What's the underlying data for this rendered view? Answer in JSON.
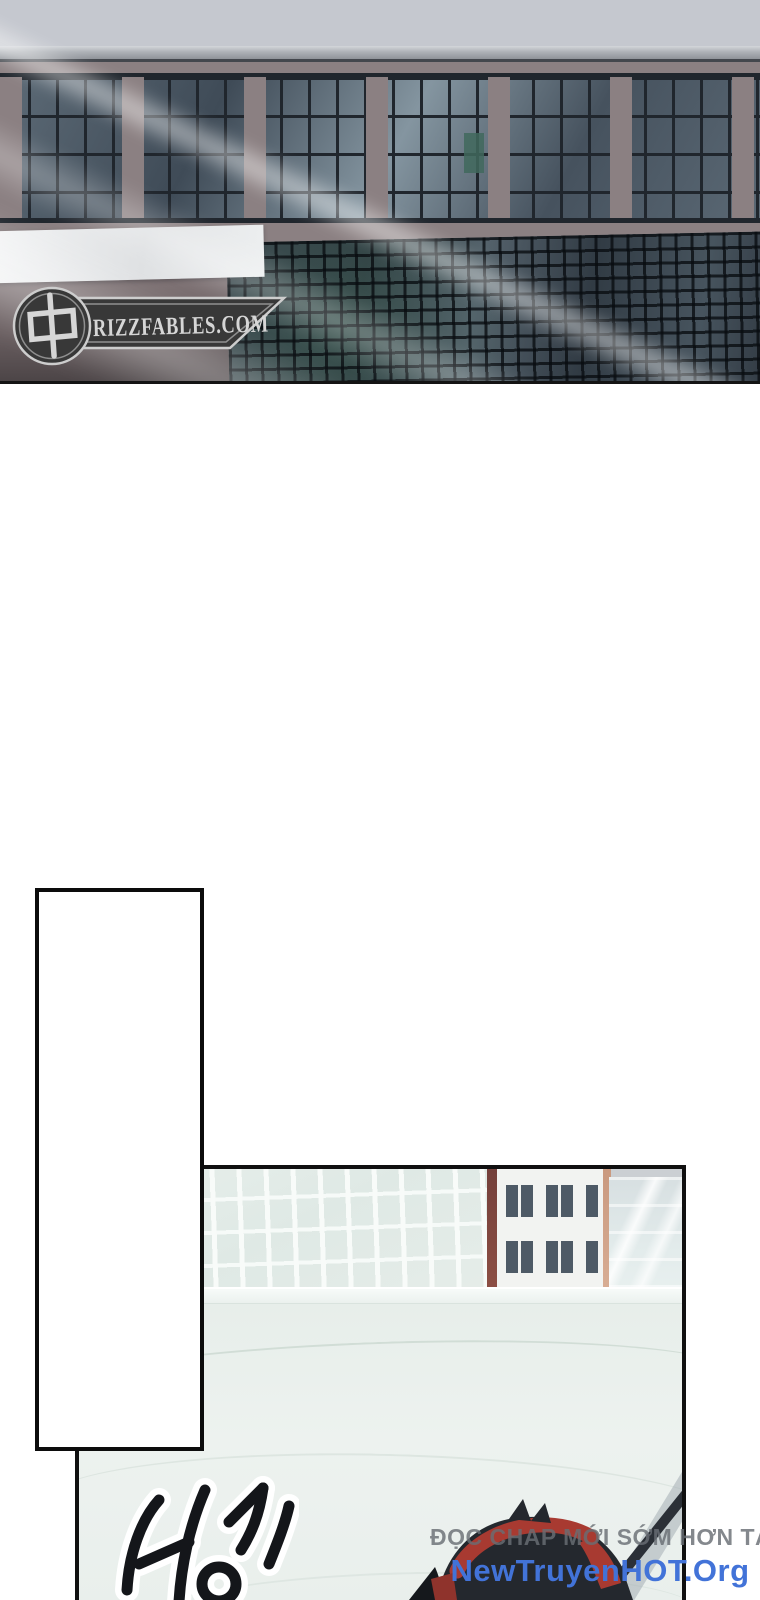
{
  "page": {
    "kind": "webtoon comic page",
    "background_color": "#ffffff"
  },
  "watermark": {
    "site_text": "RIZZFABLES.COM",
    "cjk_glyph": "中",
    "badge_fill": "#383838",
    "badge_outline": "#cdcdcd",
    "text_color": "#d6d6d6"
  },
  "panel1": {
    "description": "building facade with grid windows, white blank signboard and diagonal light streaks",
    "sky_color": "#c5c8cf",
    "wall_color": "#8b8082",
    "window_frame_color": "#20262d",
    "green_pane_color": "#41695d"
  },
  "panel2": {
    "description": "rooftop scene with pale city buildings, parapet, sound effect and partially visible figure with staff",
    "roof_color": "#eaf1ee",
    "building_red_edge": "#74403b",
    "figure_hair_color": "#24282e",
    "figure_red_color": "#a83a31"
  },
  "panel3": {
    "description": "empty white panel"
  },
  "sfx": {
    "text": "빙글",
    "style": "black brush strokes with white outline, rotated"
  },
  "promo": {
    "line1": "ĐỌC CHAP MỚI SỚM HƠN TẠI",
    "line2": "NewTruyenHOT.Org",
    "line1_color": "#6e7378",
    "line2_color": "#4273d8"
  }
}
